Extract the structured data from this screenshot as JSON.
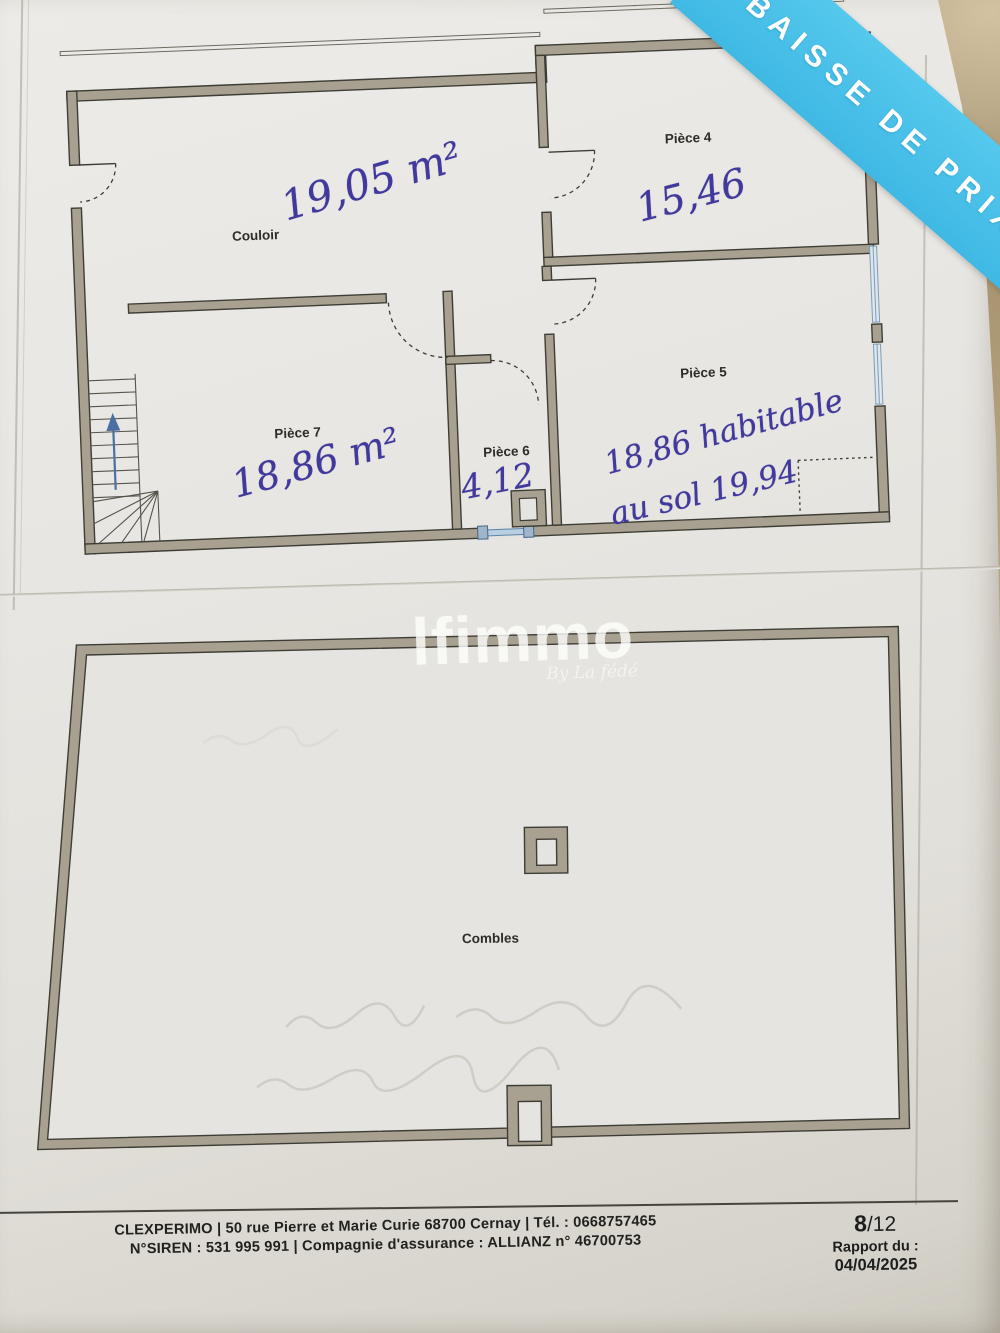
{
  "ribbon": {
    "label": "BAISSE DE PRIX"
  },
  "watermark": {
    "brand": "lfimmo",
    "tagline": "By La fédé"
  },
  "upper_plan": {
    "rooms": {
      "couloir": {
        "label": "Couloir",
        "area": "19,05 m²"
      },
      "piece4": {
        "label": "Pièce 4",
        "area": "15,46"
      },
      "piece5": {
        "label": "Pièce 5",
        "area_habitable": "18,86 habitable",
        "area_sol": "au sol 19,94"
      },
      "piece6": {
        "label": "Pièce 6",
        "area": "4,12"
      },
      "piece7": {
        "label": "Pièce 7",
        "area": "18,86 m²"
      }
    }
  },
  "lower_plan": {
    "label": "Combles"
  },
  "footer": {
    "contact": "CLEXPERIMO | 50 rue Pierre et Marie Curie 68700 Cernay | Tél. : 0668757465",
    "legal": "N°SIREN : 531 995 991 | Compagnie d'assurance : ALLIANZ n° 46700753",
    "page_current": "8",
    "page_total": "/12",
    "report_label": "Rapport du :",
    "report_date": "04/04/2025"
  },
  "colors": {
    "ribbon_blue": "#4cc2ea",
    "ink_blue": "#413a9c",
    "wall_fill": "#a8a191"
  }
}
